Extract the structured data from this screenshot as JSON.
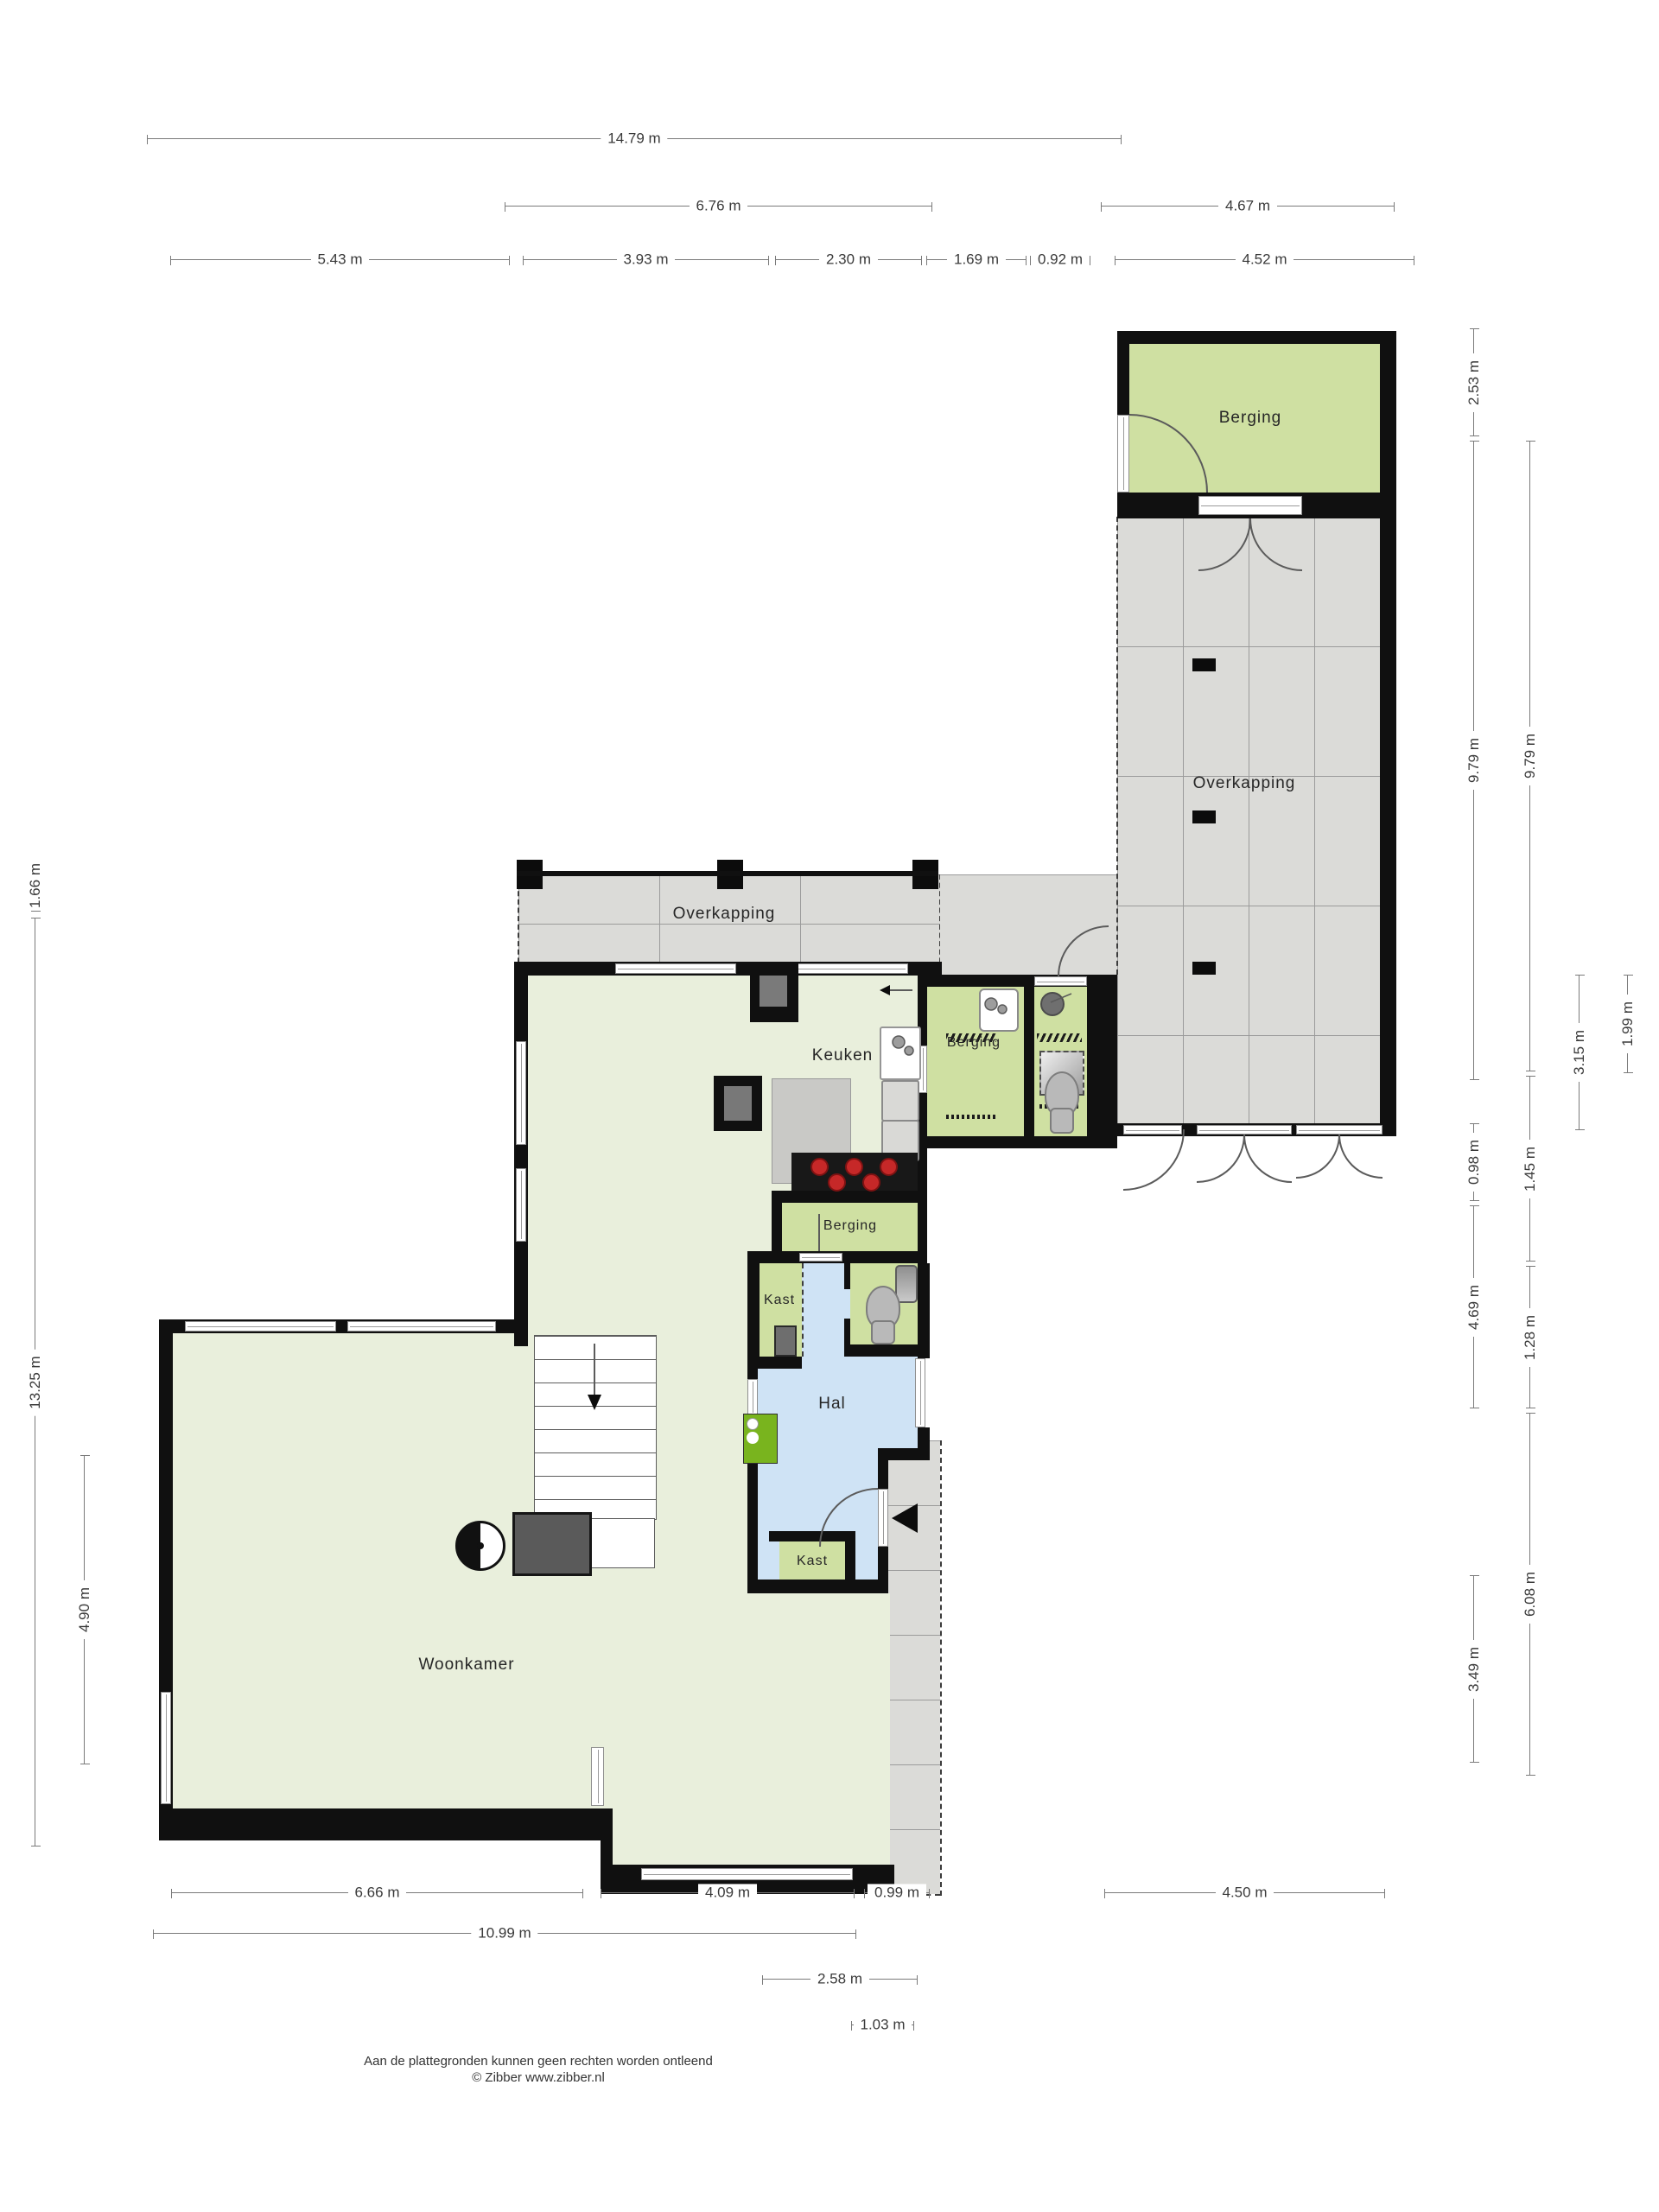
{
  "title": "Floor plan (begane grond)",
  "rooms": {
    "berging_top": "Berging",
    "overkapping_right": "Overkapping",
    "overkapping_mid": "Overkapping",
    "keuken": "Keuken",
    "berging_mid": "Berging",
    "berging_hal": "Berging",
    "kast_upper": "Kast",
    "hal": "Hal",
    "kast_lower": "Kast",
    "woonkamer": "Woonkamer"
  },
  "dimensions": {
    "top": [
      "14.79 m",
      "6.76 m",
      "4.67 m",
      "5.43 m",
      "3.93 m",
      "2.30 m",
      "1.69 m",
      "0.92 m",
      "4.52 m"
    ],
    "left": [
      "1.66 m",
      "13.25 m",
      "4.90 m"
    ],
    "right": [
      "2.53 m",
      "9.79 m",
      "0.98 m",
      "4.69 m",
      "3.49 m",
      "9.79 m",
      "1.45 m",
      "1.28 m",
      "6.08 m",
      "3.15 m",
      "1.99 m"
    ],
    "bottom": [
      "6.66 m",
      "4.09 m",
      "0.99 m",
      "4.50 m",
      "10.99 m",
      "2.58 m",
      "1.03 m"
    ]
  },
  "footer": {
    "line1": "Aan de plattegronden kunnen geen rechten worden ontleend",
    "line2": "© Zibber www.zibber.nl"
  },
  "colors": {
    "wall": "#101010",
    "room_green": "#cfe0a2",
    "floor_pale": "#e9efdc",
    "hall_blue": "#cfe3f5",
    "covered_gray": "#dbdbd8",
    "boiler_green": "#79b41e",
    "burner_red": "#c62828",
    "dim_line": "#7a7a7a"
  }
}
